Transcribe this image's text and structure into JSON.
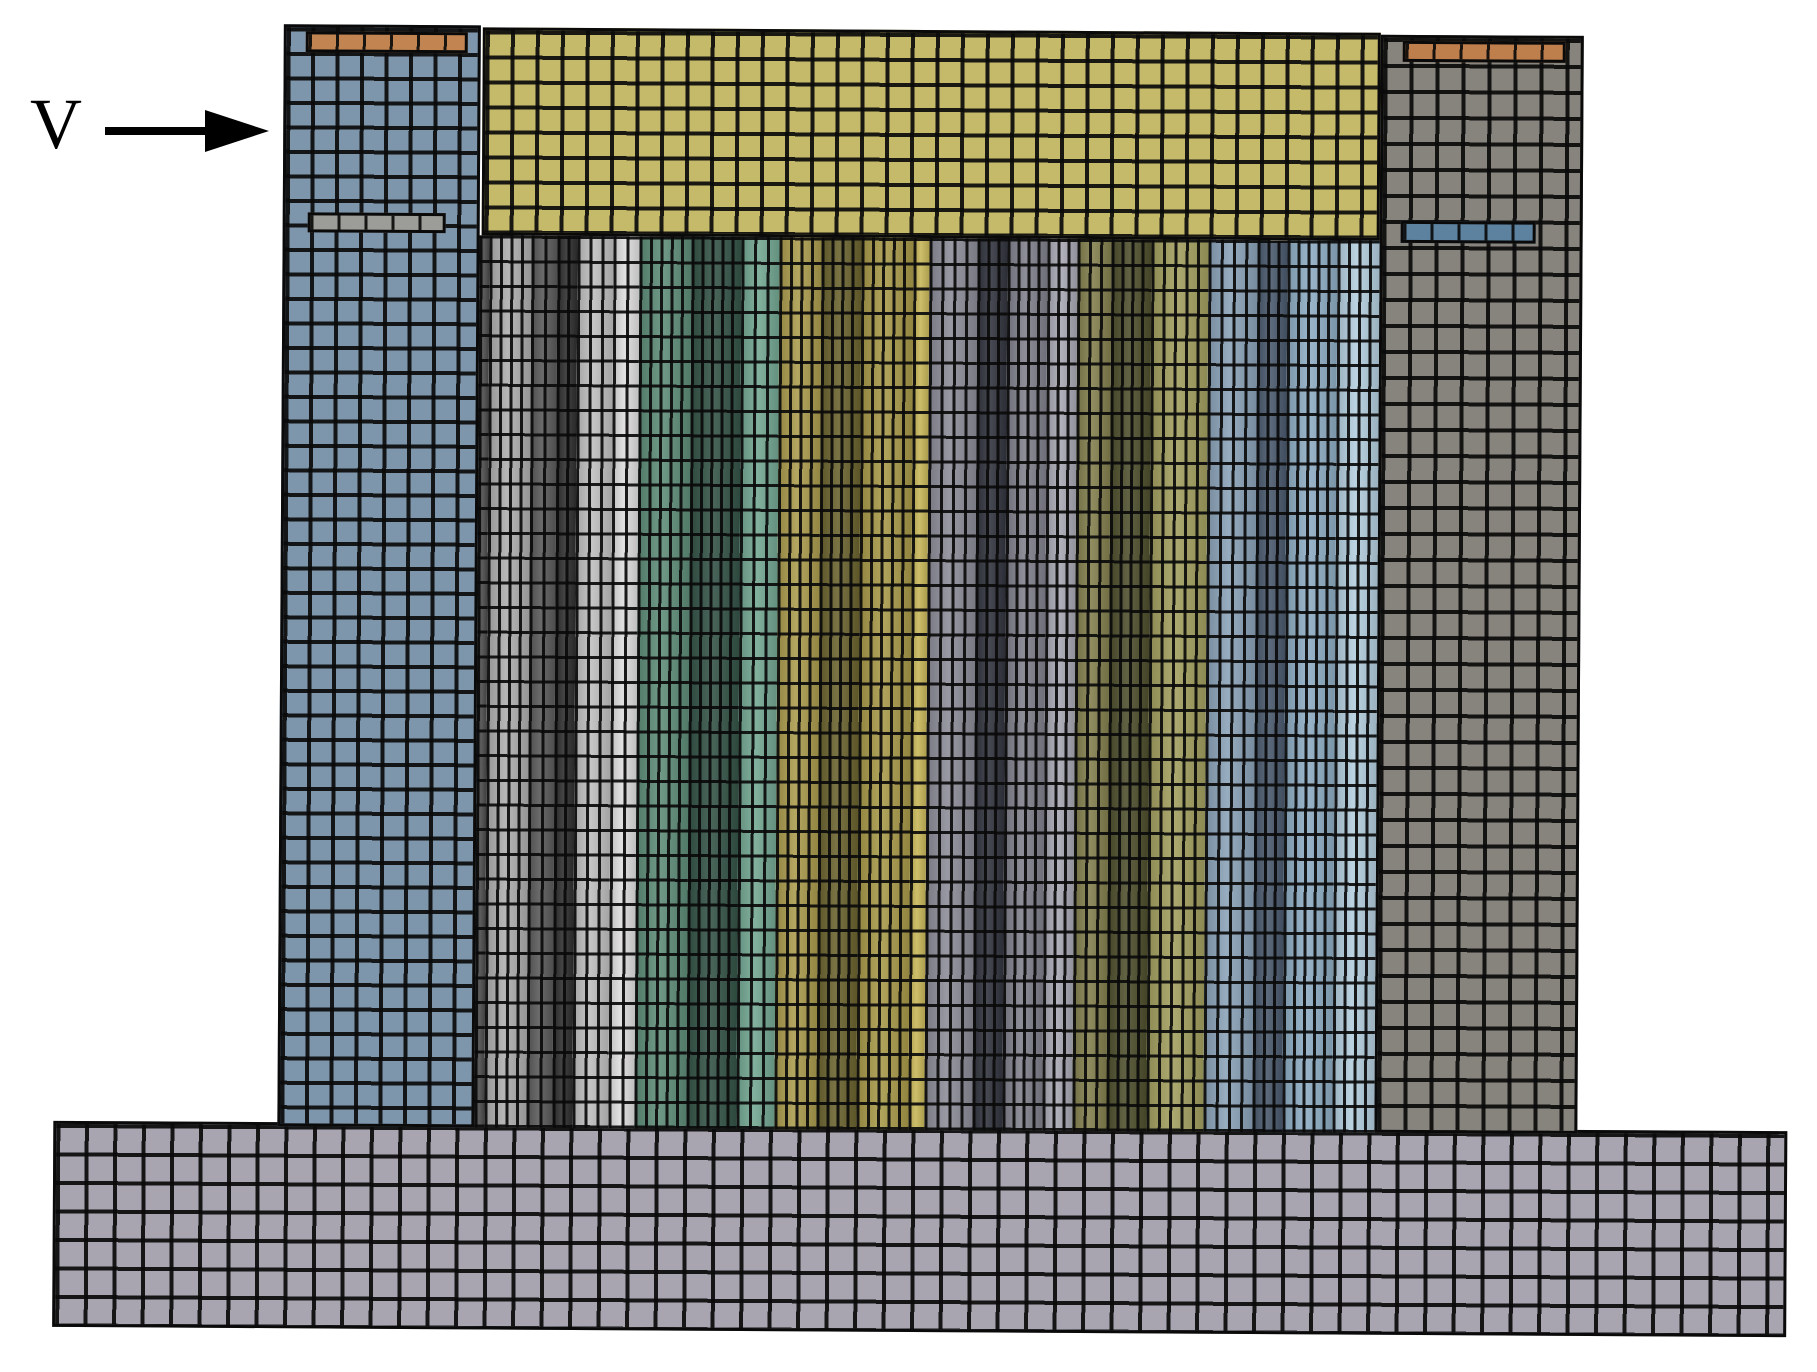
{
  "annotation": {
    "label": "V"
  },
  "figure": {
    "mesh_line_color": "rgba(10,10,10,0.92)",
    "regions": [
      {
        "name": "base-plate",
        "x": 56,
        "y": 1126,
        "w": 1734,
        "h": 206,
        "color": "#a8a5b1",
        "cw": 28.5,
        "rh": 28.5,
        "lw": 4
      },
      {
        "name": "left-blue-column",
        "x": 280,
        "y": 28,
        "w": 197,
        "h": 1102,
        "color": "#7e96ab",
        "cw": 24.5,
        "rh": 24.5,
        "lw": 4
      },
      {
        "name": "top-yellow-block",
        "x": 479,
        "y": 30,
        "w": 898,
        "h": 208,
        "color": "#c5ba69",
        "cw": 25,
        "rh": 25,
        "lw": 4
      },
      {
        "name": "right-grey-column",
        "x": 1377,
        "y": 32,
        "w": 203,
        "h": 1098,
        "color": "#87837d",
        "cw": 26,
        "rh": 26,
        "lw": 4
      },
      {
        "name": "left-column-orange-strip",
        "x": 302,
        "y": 35,
        "w": 162,
        "h": 21,
        "color": "#c28551",
        "cw": 27,
        "rh": 0,
        "lw": 3,
        "strip": true
      },
      {
        "name": "left-column-grey-strip",
        "x": 305,
        "y": 216,
        "w": 138,
        "h": 20,
        "color": "#9c9c98",
        "cw": 27,
        "rh": 0,
        "lw": 3,
        "strip": true
      },
      {
        "name": "right-column-orange-strip",
        "x": 1399,
        "y": 38,
        "w": 163,
        "h": 21,
        "color": "#bf7f4d",
        "cw": 27,
        "rh": 0,
        "lw": 3,
        "strip": true
      },
      {
        "name": "right-column-blue-strip",
        "x": 1398,
        "y": 218,
        "w": 135,
        "h": 22,
        "color": "#5c82a0",
        "cw": 27,
        "rh": 0,
        "lw": 3,
        "strip": true
      }
    ],
    "stripe_band": {
      "x": 477,
      "y": 238,
      "h": 892,
      "row": 24.7,
      "stripes": [
        {
          "color": "#4a4a4a",
          "w": 10
        },
        {
          "color": "#aeaeae",
          "w": 42
        },
        {
          "color": "#5a5a5a",
          "w": 26
        },
        {
          "color": "#2f2f2f",
          "w": 20
        },
        {
          "color": "#c0bfbf",
          "w": 36
        },
        {
          "color": "#dfdede",
          "w": 26
        },
        {
          "color": "#5f8d79",
          "w": 52
        },
        {
          "color": "#355447",
          "w": 50
        },
        {
          "color": "#74a893",
          "w": 38
        },
        {
          "color": "#ab9c4e",
          "w": 42
        },
        {
          "color": "#6a632f",
          "w": 40
        },
        {
          "color": "#a89a4a",
          "w": 52
        },
        {
          "color": "#c8b75a",
          "w": 16
        },
        {
          "color": "#8d8d99",
          "w": 48
        },
        {
          "color": "#33353f",
          "w": 30
        },
        {
          "color": "#81818d",
          "w": 40
        },
        {
          "color": "#a9a9b5",
          "w": 30
        },
        {
          "color": "#84804f",
          "w": 34
        },
        {
          "color": "#4f4f2e",
          "w": 40
        },
        {
          "color": "#a3a060",
          "w": 57
        },
        {
          "color": "#8ba3b8",
          "w": 49
        },
        {
          "color": "#4a5a6e",
          "w": 30
        },
        {
          "color": "#8fadc4",
          "w": 50
        },
        {
          "color": "#b4cede",
          "w": 42
        }
      ]
    }
  }
}
